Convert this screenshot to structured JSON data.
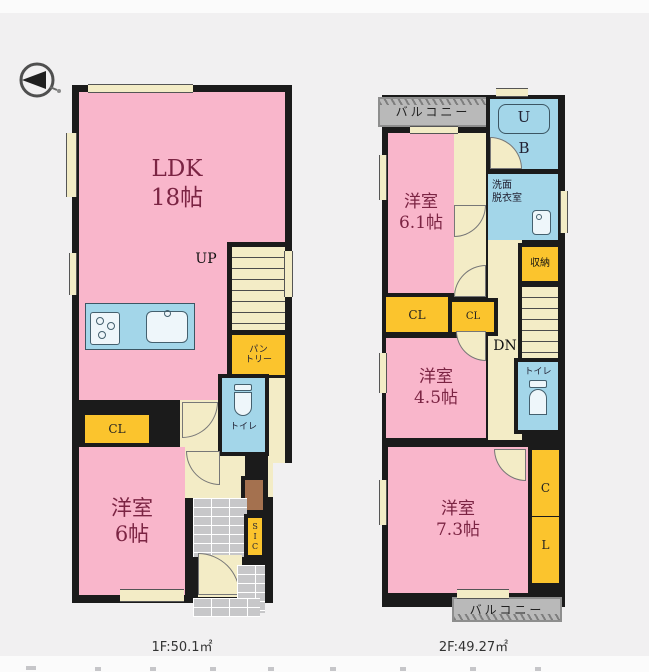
{
  "page": {
    "background": "#f1f0f1"
  },
  "colors": {
    "wall": "#1b1b1b",
    "room_pink": "#f9b6cb",
    "hall_cream": "#f3ecc6",
    "closet_yellow": "#fbc42d",
    "wet_area_blue": "#a3d6e9",
    "balcony_gray": "#b9b9b9",
    "entrance_brick_gray": "#c7c7c9",
    "label_maroon": "#7b2443"
  },
  "floor1": {
    "area_label": "1F:50.1㎡",
    "ldk": {
      "name": "LDK",
      "size": "18帖"
    },
    "up_label": "UP",
    "pantry_line1": "パン",
    "pantry_line2": "トリー",
    "toilet_label": "トイレ",
    "closet_label": "CL",
    "room6": {
      "name": "洋室",
      "size": "6帖"
    },
    "sic_label": "SIC"
  },
  "floor2": {
    "area_label": "2F:49.27㎡",
    "balcony_top_label": "バルコニー",
    "balcony_bottom_label": "バルコニー",
    "ub_line1": "U",
    "ub_line2": "B",
    "washroom_line1": "洗面",
    "washroom_line2": "脱衣室",
    "storage_label": "収納",
    "dn_label": "DN",
    "room61": {
      "name": "洋室",
      "size": "6.1帖"
    },
    "closet1_label": "CL",
    "closet2_label": "CL",
    "room45": {
      "name": "洋室",
      "size": "4.5帖"
    },
    "toilet_label": "トイレ",
    "room73": {
      "name": "洋室",
      "size": "7.3帖"
    },
    "closet_vert_line1": "C",
    "closet_vert_line2": "L"
  }
}
